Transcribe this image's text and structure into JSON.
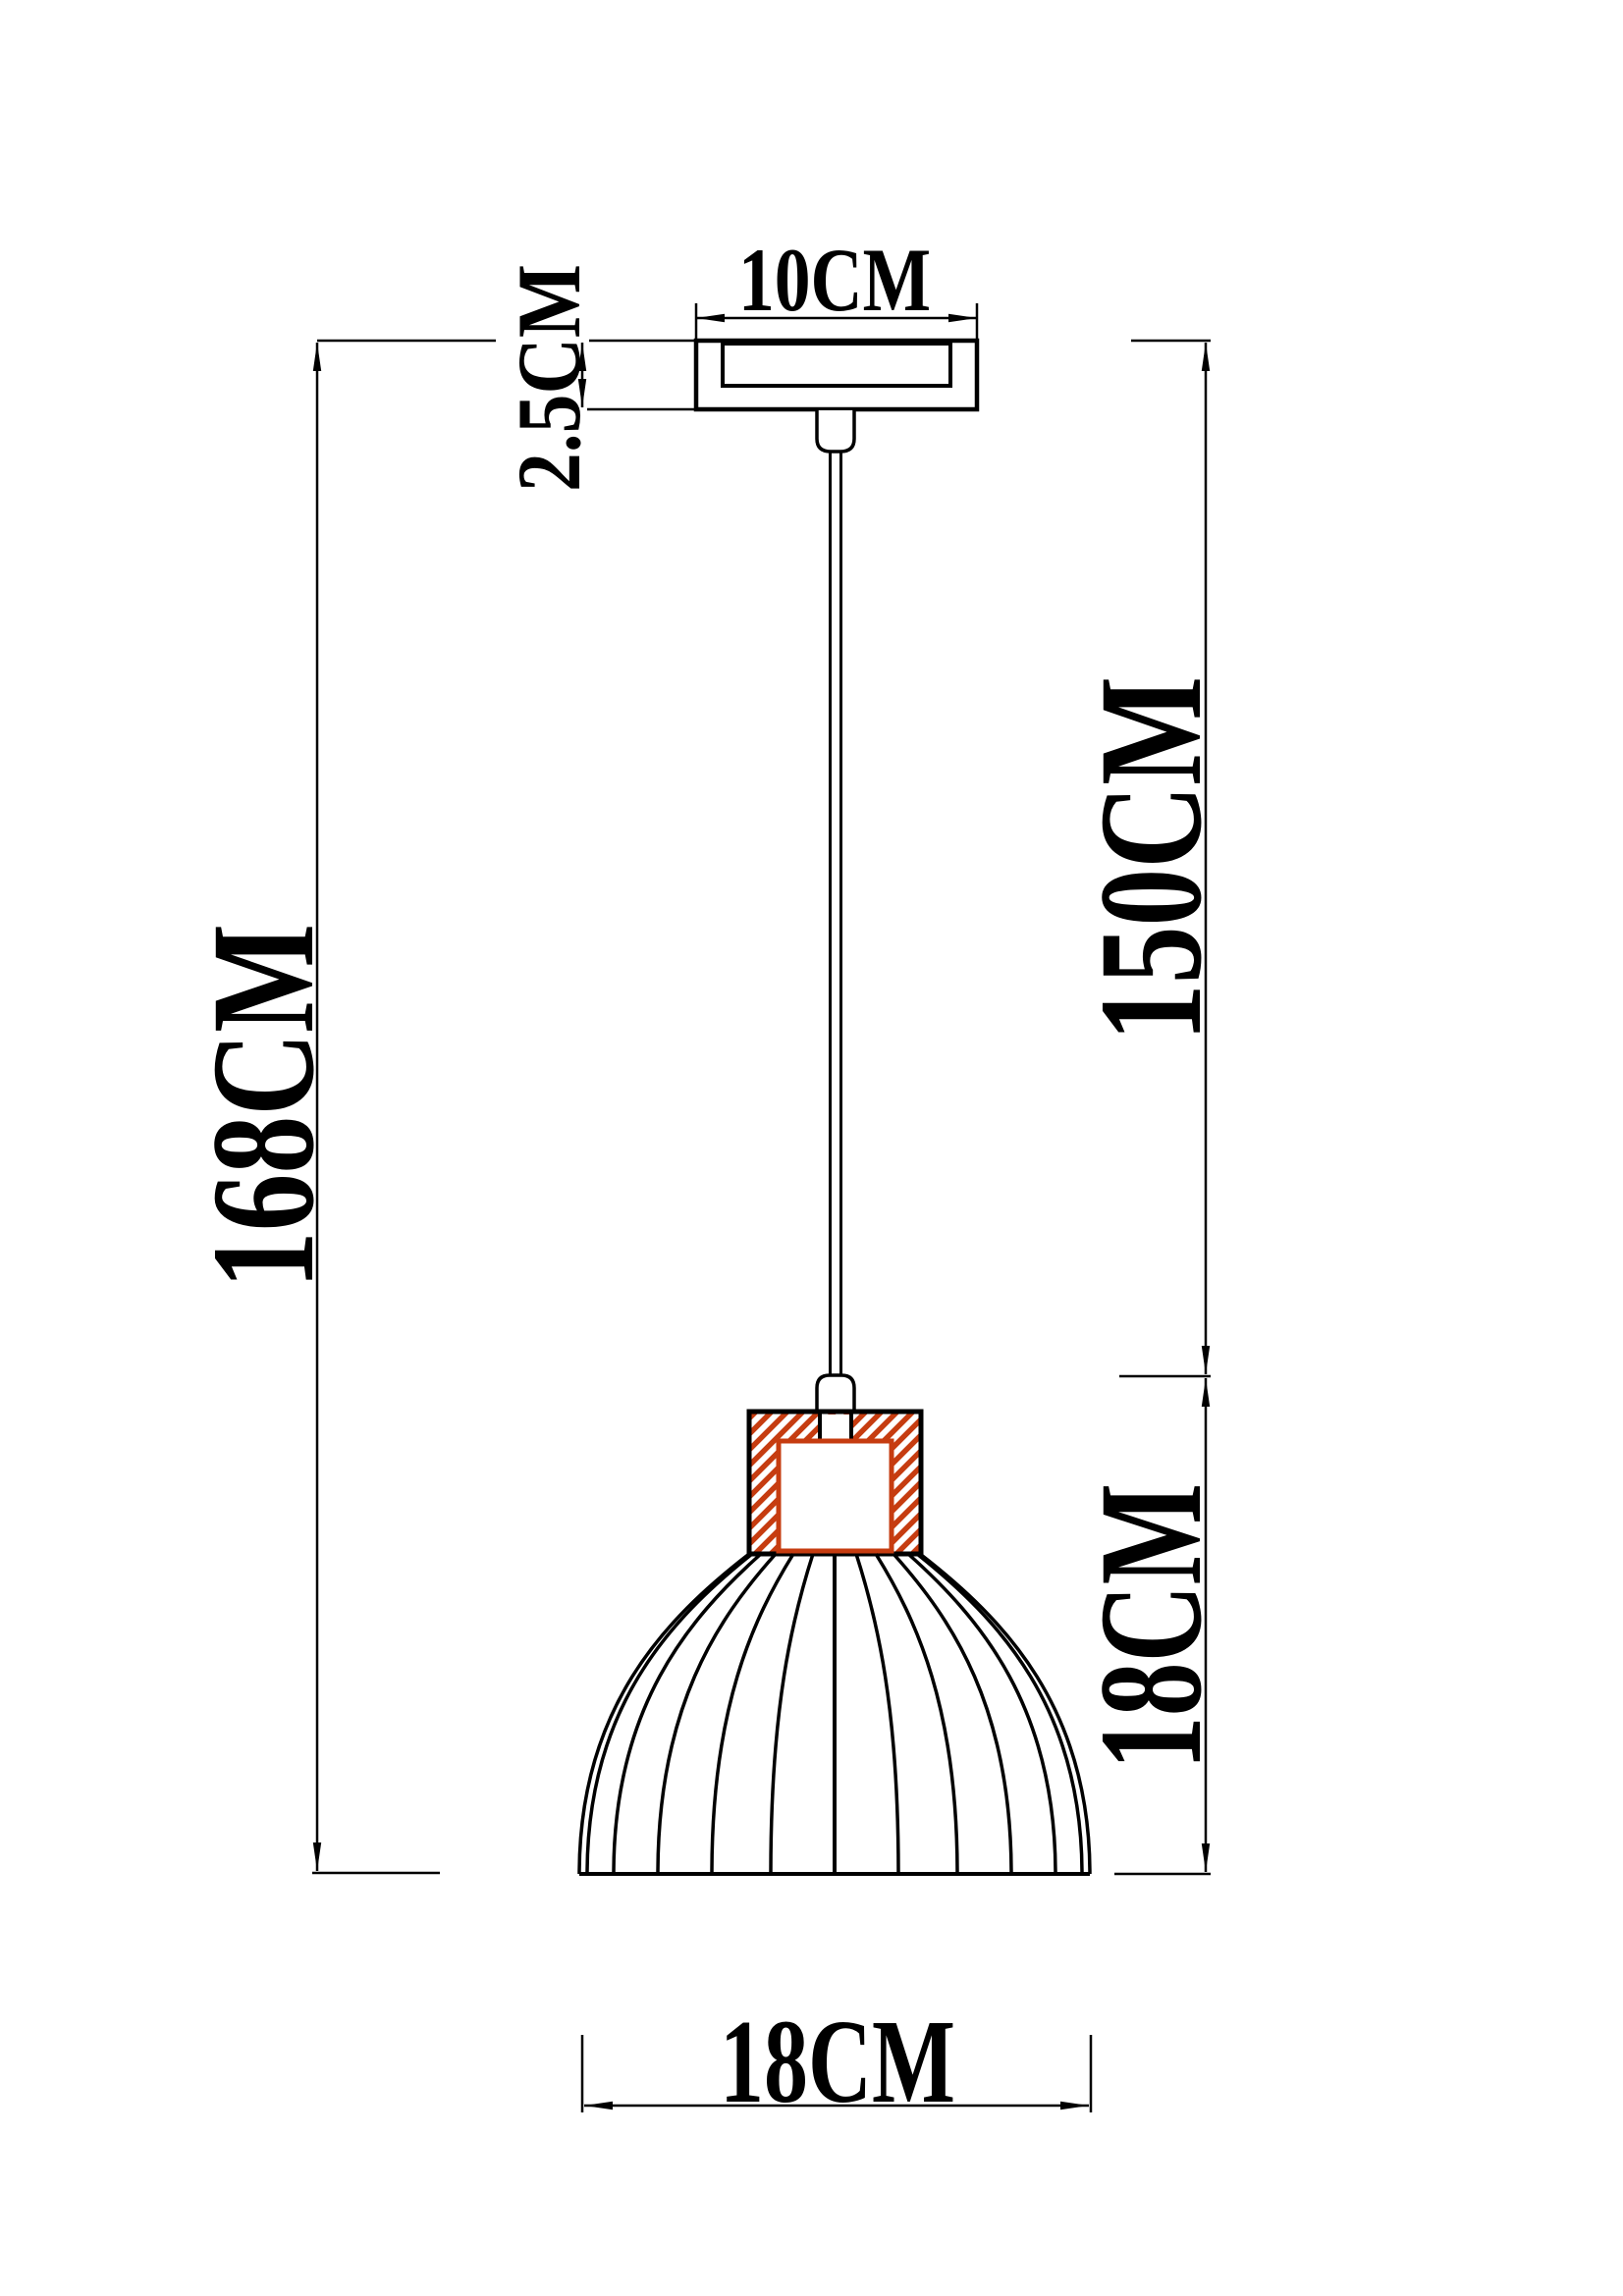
{
  "drawing": {
    "title": "Pendant lamp dimension diagram",
    "unit": "CM",
    "labels": {
      "canopy_width": "10CM",
      "canopy_height": "2.5CM",
      "overall_height": "168CM",
      "drop_height": "150CM",
      "shade_height": "18CM",
      "shade_diameter": "18CM"
    },
    "values": {
      "canopy_width_cm": 10,
      "canopy_height_cm": 2.5,
      "overall_height_cm": 168,
      "drop_height_cm": 150,
      "shade_height_cm": 18,
      "shade_diameter_cm": 18
    },
    "colors": {
      "ink": "#000000",
      "hatch": "#c63c10",
      "paper": "#ffffff"
    }
  }
}
